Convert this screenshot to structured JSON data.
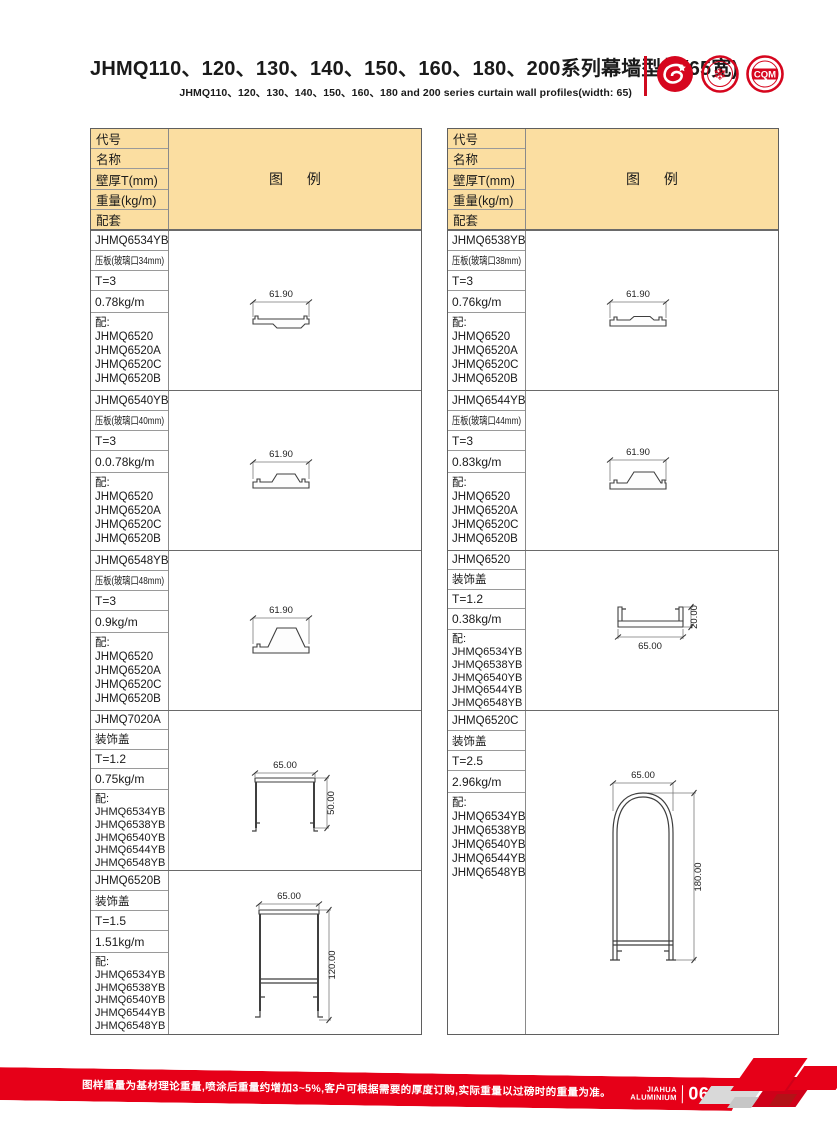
{
  "header": {
    "title": "JHMQ110、120、130、140、150、160、180、200系列幕墙型材(65宽)",
    "subtitle": "JHMQ110、120、130、140、150、160、180 and 200 series curtain wall profiles(width: 65)",
    "logo3_text": "CQM"
  },
  "table_header": {
    "rows": [
      "代号",
      "名称",
      "壁厚T(mm)",
      "重量(kg/m)",
      "配套"
    ],
    "diagram": "图 例"
  },
  "left_table": {
    "entries": [
      {
        "code": "JHMQ6534YB",
        "name": "压板(玻璃口34mm)",
        "thickness": "T=3",
        "weight": "0.78kg/m",
        "acc_label": "配:",
        "accessories": [
          "JHMQ6520",
          "JHMQ6520A",
          "JHMQ6520C",
          "JHMQ6520B"
        ],
        "dims": {
          "w": "61.90"
        }
      },
      {
        "code": "JHMQ6540YB",
        "name": "压板(玻璃口40mm)",
        "thickness": "T=3",
        "weight": "0.0.78kg/m",
        "acc_label": "配:",
        "accessories": [
          "JHMQ6520",
          "JHMQ6520A",
          "JHMQ6520C",
          "JHMQ6520B"
        ],
        "dims": {
          "w": "61.90"
        }
      },
      {
        "code": "JHMQ6548YB",
        "name": "压板(玻璃口48mm)",
        "thickness": "T=3",
        "weight": "0.9kg/m",
        "acc_label": "配:",
        "accessories": [
          "JHMQ6520",
          "JHMQ6520A",
          "JHMQ6520C",
          "JHMQ6520B"
        ],
        "dims": {
          "w": "61.90"
        }
      },
      {
        "code": "JHMQ7020A",
        "name": "装饰盖",
        "thickness": "T=1.2",
        "weight": "0.75kg/m",
        "acc_label": "配:",
        "accessories": [
          "JHMQ6534YB",
          "JHMQ6538YB",
          "JHMQ6540YB",
          "JHMQ6544YB",
          "JHMQ6548YB"
        ],
        "dims": {
          "w": "65.00",
          "h": "50.00"
        }
      },
      {
        "code": "JHMQ6520B",
        "name": "装饰盖",
        "thickness": "T=1.5",
        "weight": "1.51kg/m",
        "acc_label": "配:",
        "accessories": [
          "JHMQ6534YB",
          "JHMQ6538YB",
          "JHMQ6540YB",
          "JHMQ6544YB",
          "JHMQ6548YB"
        ],
        "dims": {
          "w": "65.00",
          "h": "120.00"
        }
      }
    ]
  },
  "right_table": {
    "entries": [
      {
        "code": "JHMQ6538YB",
        "name": "压板(玻璃口38mm)",
        "thickness": "T=3",
        "weight": "0.76kg/m",
        "acc_label": "配:",
        "accessories": [
          "JHMQ6520",
          "JHMQ6520A",
          "JHMQ6520C",
          "JHMQ6520B"
        ],
        "dims": {
          "w": "61.90"
        }
      },
      {
        "code": "JHMQ6544YB",
        "name": "压板(玻璃口44mm)",
        "thickness": "T=3",
        "weight": "0.83kg/m",
        "acc_label": "配:",
        "accessories": [
          "JHMQ6520",
          "JHMQ6520A",
          "JHMQ6520C",
          "JHMQ6520B"
        ],
        "dims": {
          "w": "61.90"
        }
      },
      {
        "code": "JHMQ6520",
        "name": "装饰盖",
        "thickness": "T=1.2",
        "weight": "0.38kg/m",
        "acc_label": "配:",
        "accessories": [
          "JHMQ6534YB",
          "JHMQ6538YB",
          "JHMQ6540YB",
          "JHMQ6544YB",
          "JHMQ6548YB"
        ],
        "dims": {
          "w": "65.00",
          "h": "20.00"
        }
      },
      {
        "code": "JHMQ6520C",
        "name": "装饰盖",
        "thickness": "T=2.5",
        "weight": "2.96kg/m",
        "acc_label": "配:",
        "accessories": [
          "JHMQ6534YB",
          "JHMQ6538YB",
          "JHMQ6540YB",
          "JHMQ6544YB",
          "JHMQ6548YB"
        ],
        "dims": {
          "w": "65.00",
          "h": "180.00"
        }
      }
    ]
  },
  "footer": {
    "note": "图样重量为基材理论重量,喷涂后重量约增加3~5%,客户可根据需要的厚度订购,实际重量以过磅时的重量为准。",
    "brand_top": "JIAHUA",
    "brand_bottom": "ALUMINIUM",
    "page": "067"
  },
  "colors": {
    "header_bg": "#FBDEA1",
    "accent_red": "#E60018"
  }
}
